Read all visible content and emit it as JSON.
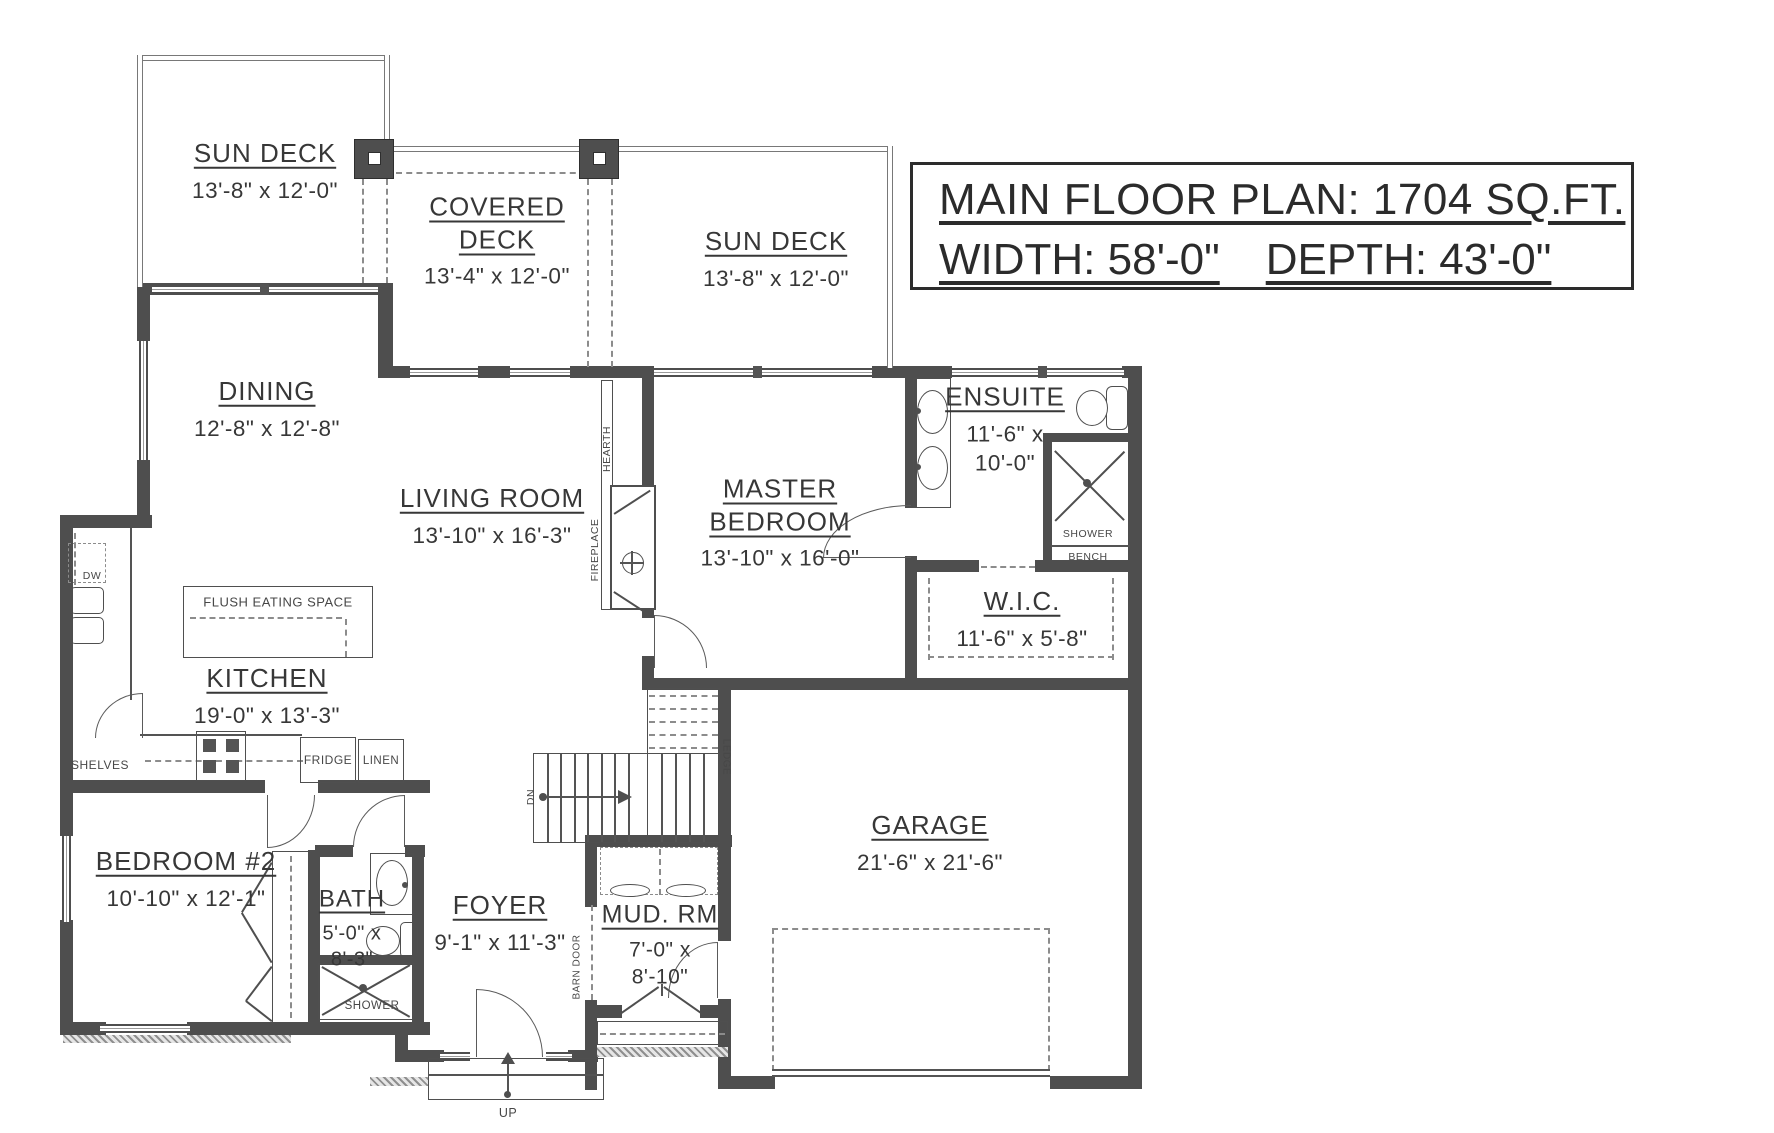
{
  "title_block": {
    "line1": "MAIN FLOOR PLAN: 1704 SQ.FT.",
    "line2a": "WIDTH: 58'-0\"",
    "line2b": "DEPTH: 43'-0\""
  },
  "rooms": {
    "sun_deck_left": {
      "name": "SUN DECK",
      "dims": "13'-8\" x 12'-0\""
    },
    "covered_deck": {
      "name": "COVERED DECK",
      "dims": "13'-4\" x 12'-0\""
    },
    "sun_deck_right": {
      "name": "SUN DECK",
      "dims": "13'-8\" x 12'-0\""
    },
    "dining": {
      "name": "DINING",
      "dims": "12'-8\" x 12'-8\""
    },
    "living_room": {
      "name": "LIVING ROOM",
      "dims": "13'-10\" x 16'-3\""
    },
    "master_bedroom": {
      "name": "MASTER BEDROOM",
      "dims": "13'-10\" x 16'-0\""
    },
    "ensuite": {
      "name": "ENSUITE",
      "dims_line1": "11'-6\" x",
      "dims_line2": "10'-0\""
    },
    "wic": {
      "name": "W.I.C.",
      "dims": "11'-6\" x 5'-8\""
    },
    "kitchen": {
      "name": "KITCHEN",
      "dims": "19'-0\" x 13'-3\""
    },
    "bedroom2": {
      "name": "BEDROOM #2",
      "dims": "10'-10\" x 12'-1\""
    },
    "bath": {
      "name": "BATH",
      "dims_line1": "5'-0\" x",
      "dims_line2": "8'-3\""
    },
    "foyer": {
      "name": "FOYER",
      "dims": "9'-1\" x 11'-3\""
    },
    "mud_room": {
      "name": "MUD. RM",
      "dims_line1": "7'-0\" x",
      "dims_line2": "8'-10\""
    },
    "garage": {
      "name": "GARAGE",
      "dims": "21'-6\" x 21'-6\""
    }
  },
  "labels": {
    "flush_eating_space": "FLUSH EATING SPACE",
    "shelves": "SHELVES",
    "fridge": "FRIDGE",
    "linen": "LINEN",
    "dw": "DW",
    "shower_bath": "SHOWER",
    "shower_ensuite": "SHOWER",
    "bench": "BENCH",
    "hearth": "HEARTH",
    "fireplace": "FIREPLACE",
    "ledge": "LEDGE",
    "dn": "DN",
    "up": "UP",
    "barn_door": "BARN DOOR"
  },
  "colors": {
    "wall": "#4e4e4e",
    "line": "#545454",
    "text": "#373737",
    "dash": "#8c8c8c"
  }
}
